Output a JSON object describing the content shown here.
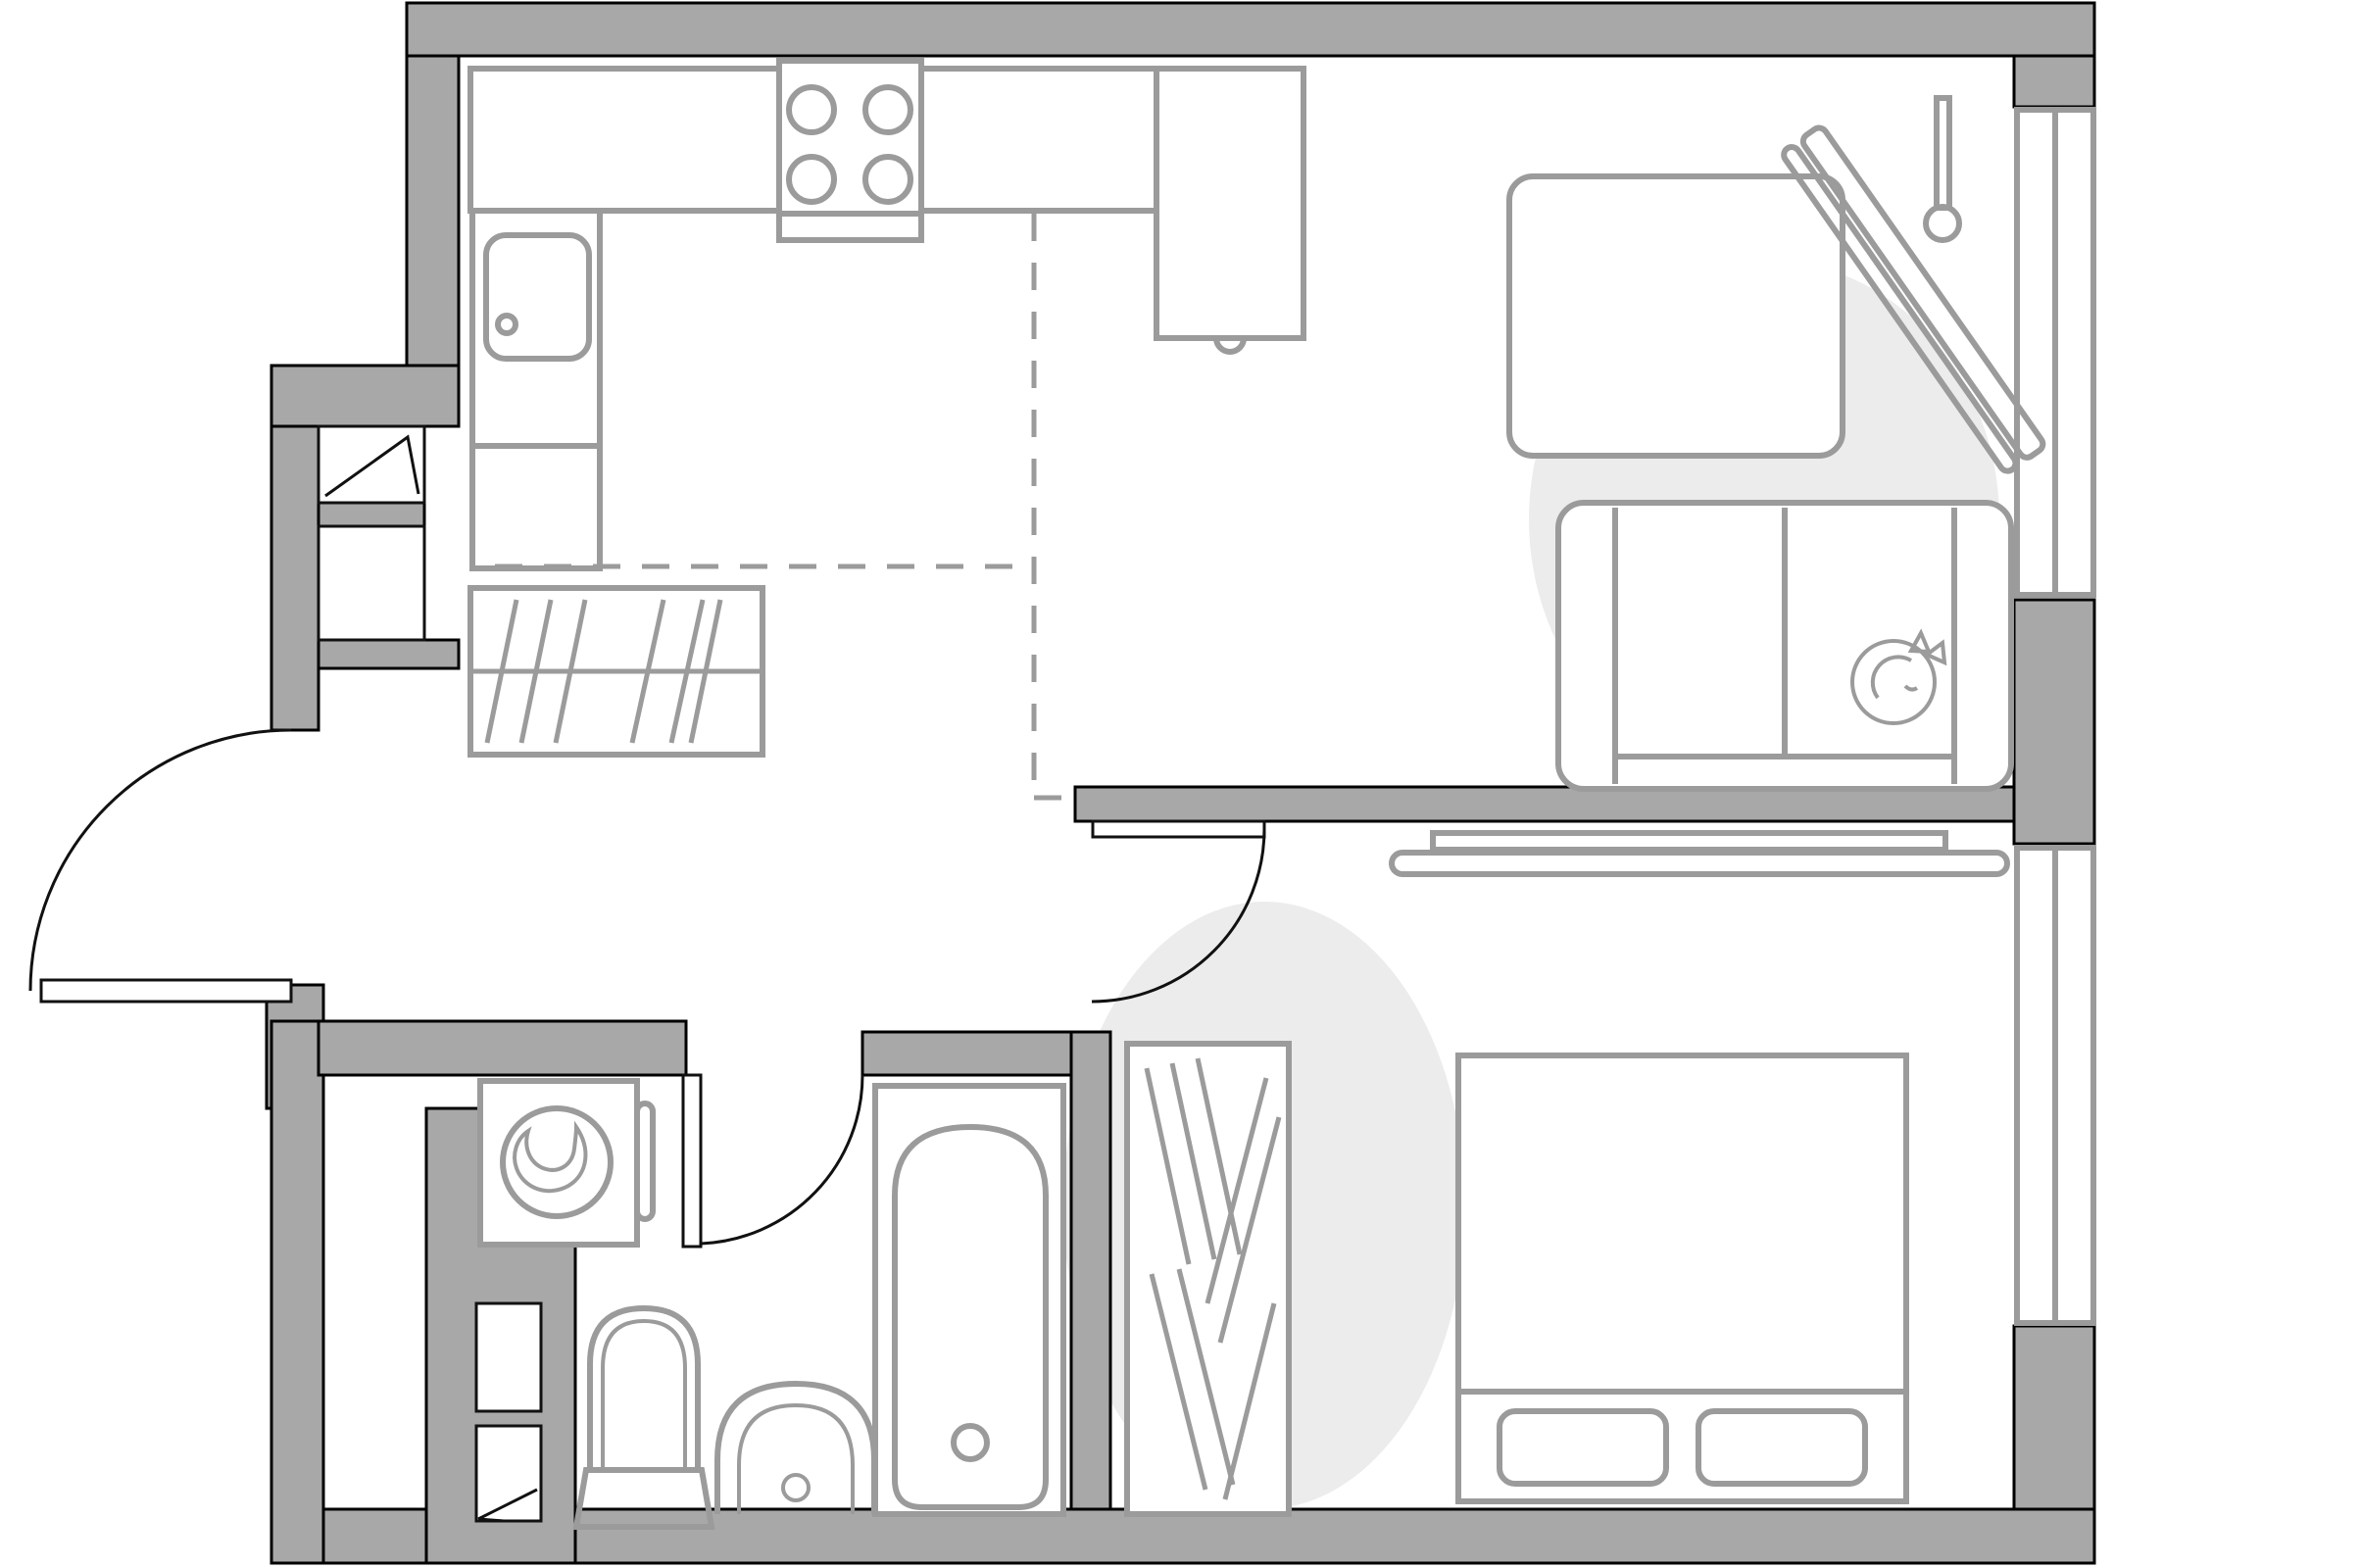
{
  "meta": {
    "kind": "apartment-floor-plan",
    "visible_text": []
  },
  "colors": {
    "background": "#ffffff",
    "wall_fill": "#a8a8a8",
    "wall_outline": "#000000",
    "furniture_stroke": "#9b9b9b",
    "accent_fill": "#ececec",
    "door_stroke": "#111111"
  },
  "rooms": [
    {
      "name": "kitchen",
      "items": [
        "counter",
        "stove-burners",
        "kitchen-sink",
        "refrigerator",
        "closet-hatched"
      ]
    },
    {
      "name": "living-room",
      "items": [
        "dining-table",
        "sofa",
        "cat",
        "drying-rack",
        "window"
      ]
    },
    {
      "name": "bedroom",
      "items": [
        "double-bed",
        "pillows",
        "wardrobe-hatched",
        "wall-tv",
        "window"
      ]
    },
    {
      "name": "bathroom",
      "items": [
        "washing-machine",
        "toilet",
        "hand-basin",
        "bathtub"
      ]
    },
    {
      "name": "hallway",
      "items": [
        "entry-door",
        "shaft-boxes",
        "zone-dashed-lines"
      ]
    }
  ],
  "windows": 2,
  "doors": [
    "entry",
    "bathroom",
    "bedroom"
  ]
}
